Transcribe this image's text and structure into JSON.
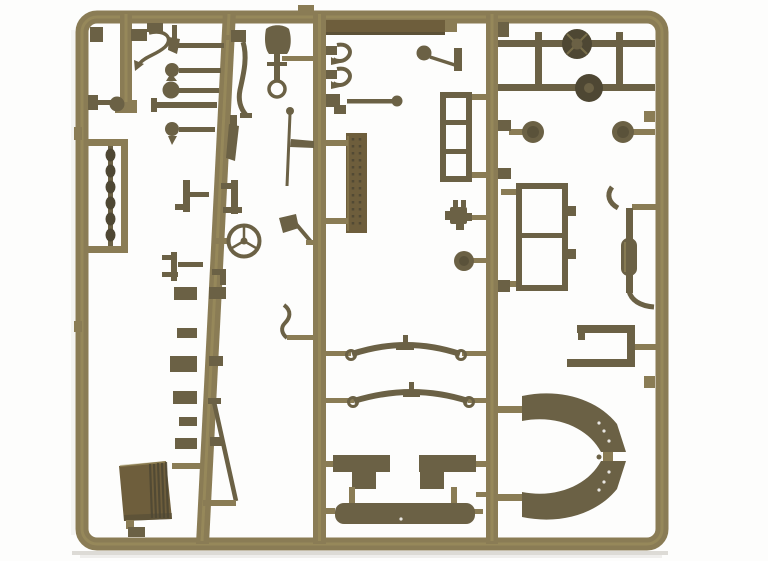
{
  "description": "Photograph of an olive-drab injection-moulded plastic sprue holding the parts of a small military-vehicle (jeep) model kit, laid on a plain white background. The rectangular runner frame has four vertical runners; attached parts include two axles with round differentials, two headlight discs, a two-pane windshield frame, a three-pane radiator-guard frame, an exhaust pipe with muffler, a tow bracket, two curved fenders, two leaf springs, two seat cushions and a long rear bench, a ribbed radiator, a steering wheel, a shovel, a hatchet, tow hooks, a perforated stowage plate, chain links, levers, rods and assorted small brackets.",
  "palette": {
    "background": "#fdfdfc",
    "shadow": "#a9a499",
    "plastic_light": "#a2935f",
    "plastic_mid": "#8a7c55",
    "plastic_dark": "#6b6145",
    "plastic_deep": "#4e4733",
    "plastic_brown": "#6e5e3c"
  },
  "parts": [
    {
      "id": "outer-frame",
      "label": "rounded rectangular sprue frame"
    },
    {
      "id": "runner-left-stub",
      "label": "short top-left runner"
    },
    {
      "id": "runner-2",
      "label": "slanted vertical runner"
    },
    {
      "id": "runner-3",
      "label": "central vertical runner"
    },
    {
      "id": "runner-4",
      "label": "right vertical runner"
    },
    {
      "id": "pull-cable",
      "label": "curved pull cable with hook"
    },
    {
      "id": "mirror",
      "label": "rear-view mirror on stem"
    },
    {
      "id": "chain-links",
      "label": "chain of links inside sub-frame"
    },
    {
      "id": "hand-lever-cluster",
      "label": "cluster of ball-tipped hand levers"
    },
    {
      "id": "foot-pedal-lever",
      "label": "curved foot pedal lever"
    },
    {
      "id": "taper-lever",
      "label": "tapered lever"
    },
    {
      "id": "bracket-pair",
      "label": "mounting brackets"
    },
    {
      "id": "steering-wheel",
      "label": "three-spoke steering wheel"
    },
    {
      "id": "fork-bracket",
      "label": "forked bracket"
    },
    {
      "id": "lower-blocks",
      "label": "assorted small blocks on runner 2"
    },
    {
      "id": "linkage-rod-right",
      "label": "long diagonal linkage rod"
    },
    {
      "id": "radiator",
      "label": "ribbed radiator"
    },
    {
      "id": "front-bumper-strip",
      "label": "flat front bumper bar"
    },
    {
      "id": "shovel",
      "label": "shovel with D-handle"
    },
    {
      "id": "tow-hooks",
      "label": "two tow hooks"
    },
    {
      "id": "tie-rod",
      "label": "tie rod with ball end"
    },
    {
      "id": "gear-lever",
      "label": "gear lever with ball knob"
    },
    {
      "id": "stowage-plate",
      "label": "perforated stowage plate"
    },
    {
      "id": "antenna-rod",
      "label": "thin antenna rod"
    },
    {
      "id": "hatchet",
      "label": "hatchet"
    },
    {
      "id": "shift-lever",
      "label": "small S-shaped lever"
    },
    {
      "id": "leaf-spring-front",
      "label": "leaf spring with eyelets"
    },
    {
      "id": "leaf-spring-rear",
      "label": "leaf spring with eyelets"
    },
    {
      "id": "seat-left",
      "label": "left seat cushion"
    },
    {
      "id": "seat-right",
      "label": "right seat cushion"
    },
    {
      "id": "rear-bench",
      "label": "long rear bench seat"
    },
    {
      "id": "front-axle",
      "label": "axle with round differential"
    },
    {
      "id": "rear-axle",
      "label": "axle with round differential"
    },
    {
      "id": "headlight-left",
      "label": "headlight disc"
    },
    {
      "id": "headlight-right",
      "label": "headlight disc"
    },
    {
      "id": "radiator-guard",
      "label": "three-pane guard frame"
    },
    {
      "id": "windshield-frame",
      "label": "two-pane windshield frame"
    },
    {
      "id": "carburetor",
      "label": "small knobby engine part"
    },
    {
      "id": "horn-disc",
      "label": "small disc"
    },
    {
      "id": "exhaust-assembly",
      "label": "exhaust pipe with muffler"
    },
    {
      "id": "tow-bracket",
      "label": "towing bracket"
    },
    {
      "id": "fender-upper",
      "label": "curved fender panel"
    },
    {
      "id": "fender-lower",
      "label": "curved fender panel"
    },
    {
      "id": "frame-tabs",
      "label": "small molding tabs on frame"
    }
  ]
}
